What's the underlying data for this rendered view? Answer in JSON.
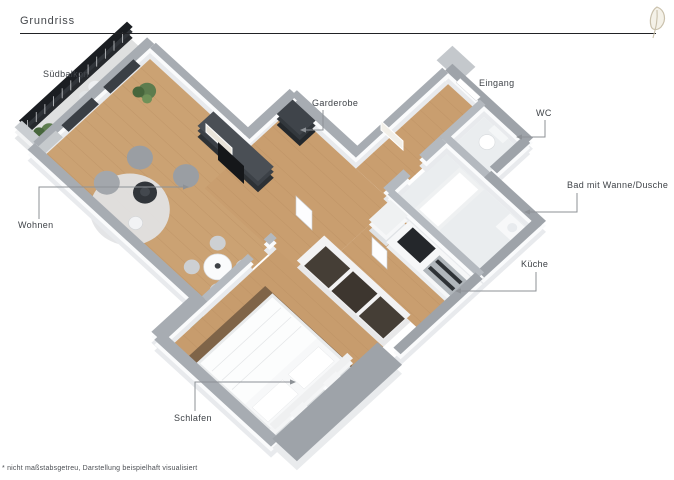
{
  "header": {
    "title": "Grundriss"
  },
  "floorplan": {
    "labels": [
      {
        "id": "suedbalkon",
        "text": "Südbalkon"
      },
      {
        "id": "wohnen",
        "text": "Wohnen"
      },
      {
        "id": "garderobe",
        "text": "Garderobe"
      },
      {
        "id": "eingang",
        "text": "Eingang"
      },
      {
        "id": "wc",
        "text": "WC"
      },
      {
        "id": "bad",
        "text": "Bad mit Wanne/Dusche"
      },
      {
        "id": "kueche",
        "text": "Küche"
      },
      {
        "id": "schlafen",
        "text": "Schlafen"
      }
    ]
  },
  "palette": {
    "wood": "#c99e6f",
    "wood_dark": "#7b6147",
    "wall_cap": "#a7acb2",
    "wall_cap_outer": "#9ea3a9",
    "wall_face": "#fafbfc",
    "railing": "#1b1e22",
    "bath_floor": "#eaedef",
    "leader": "#8d9196",
    "label_text": "#3f4348",
    "logo": "#c9c0ab"
  },
  "footer": {
    "disclaimer": "* nicht maßstabsgetreu, Darstellung beispielhaft visualisiert"
  }
}
